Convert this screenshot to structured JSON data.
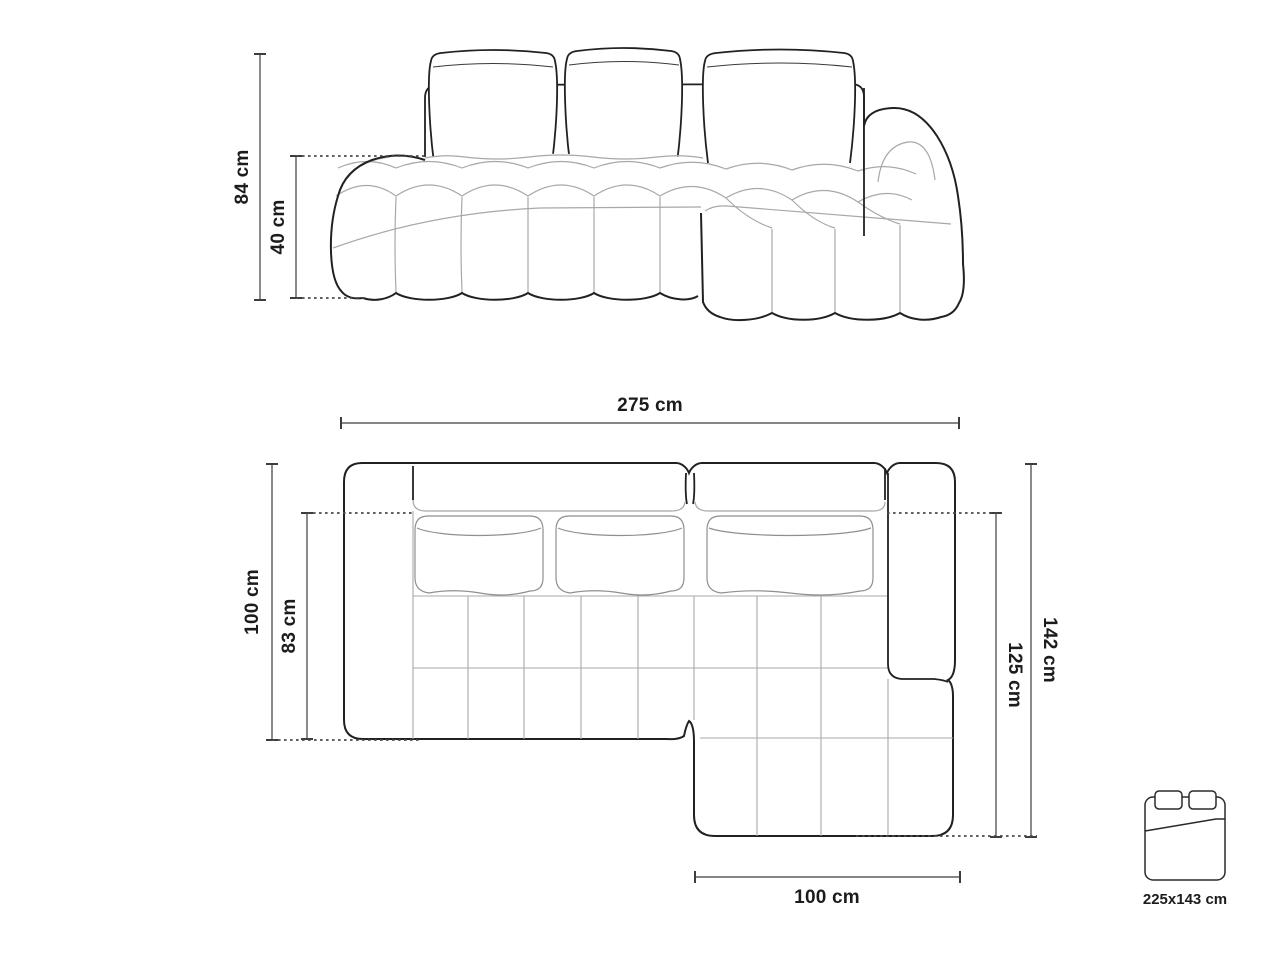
{
  "front_view": {
    "total_height_label": "84 cm",
    "seat_height_label": "40 cm"
  },
  "top_view": {
    "total_width_label": "275 cm",
    "left_depth_label": "100 cm",
    "seat_depth_label": "83 cm",
    "chaise_outer_label": "142 cm",
    "chaise_inner_label": "125 cm",
    "chaise_width_label": "100 cm"
  },
  "sleeping_area": {
    "size_label": "225x143 cm"
  },
  "colors": {
    "background": "#ffffff",
    "outline": "#212121",
    "seam": "#a8a8a8",
    "dimension_line": "#3d3d3d",
    "dotted_line": "#4a4a4a"
  }
}
